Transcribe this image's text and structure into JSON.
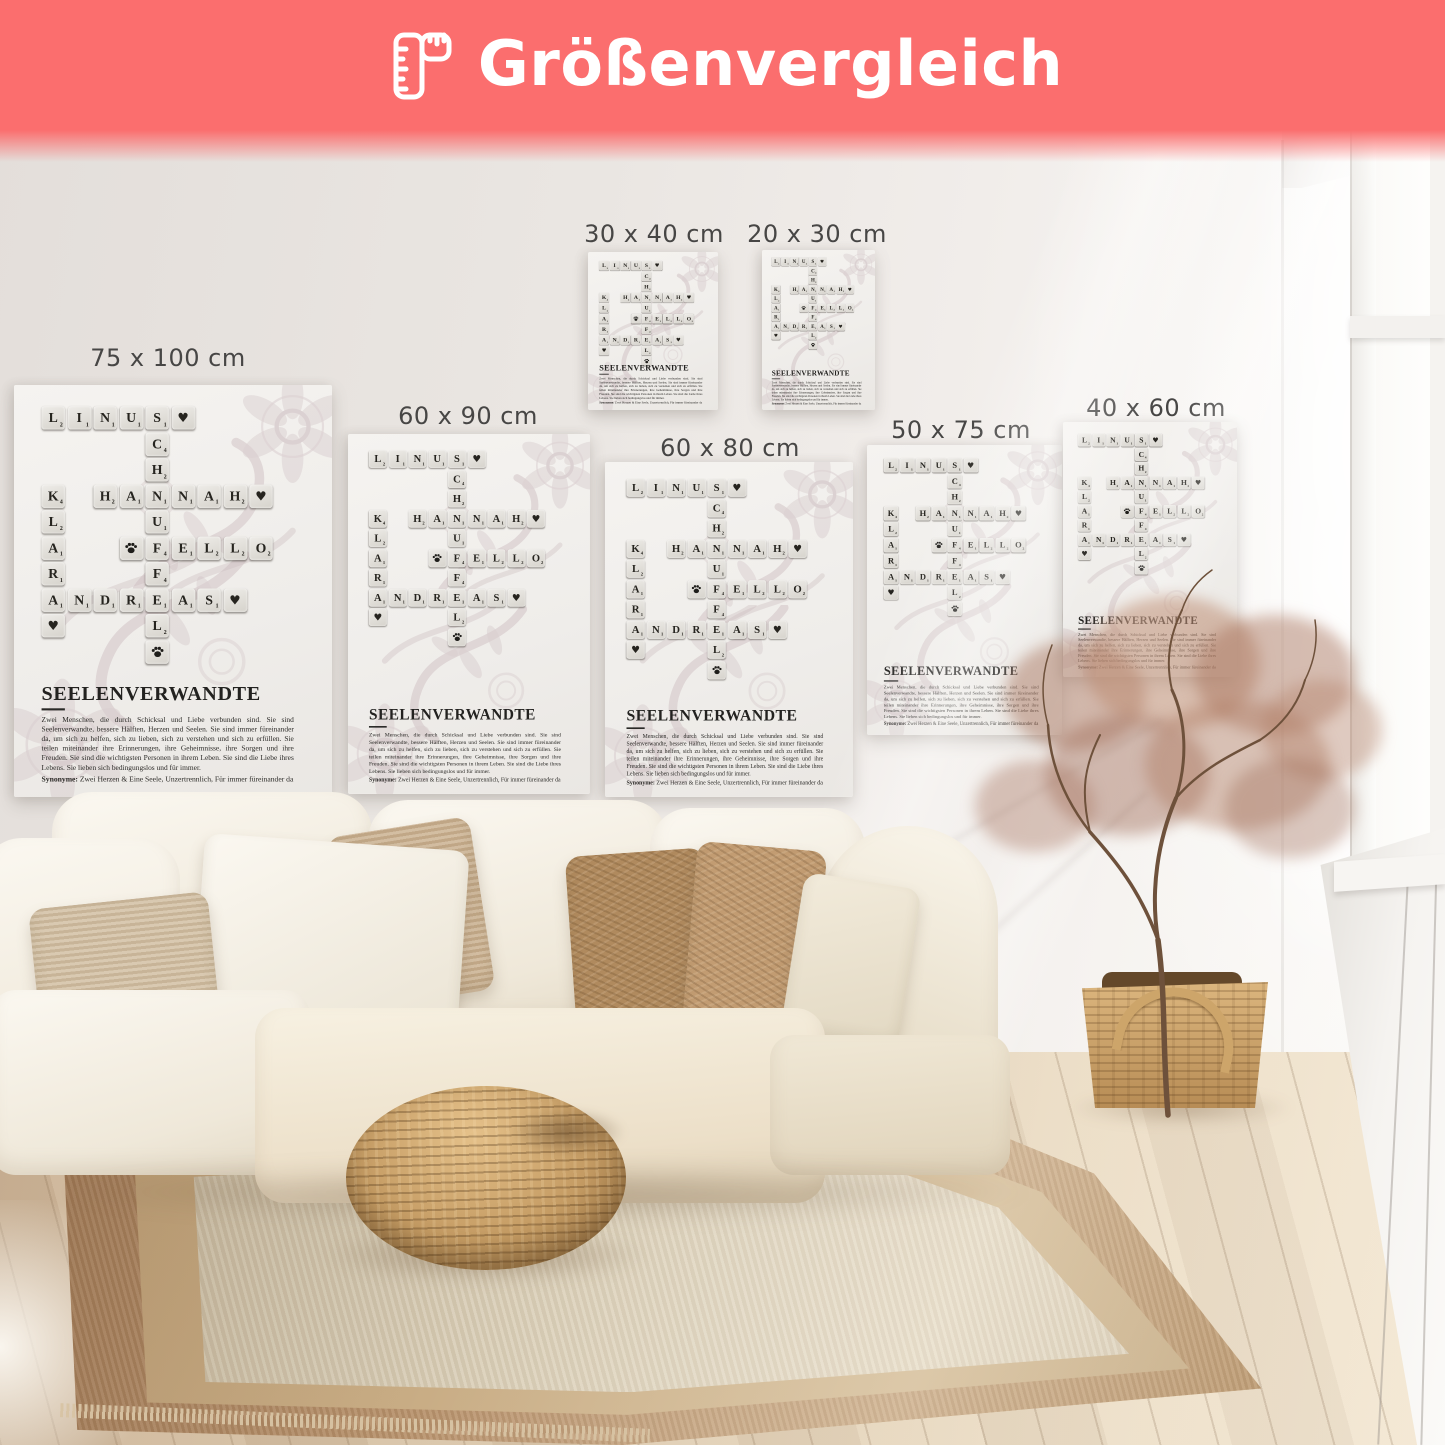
{
  "banner": {
    "title": "Größenvergleich",
    "background": "#fb6e6e",
    "text_color": "#ffffff",
    "icon": "folding-ruler-icon"
  },
  "posters": [
    {
      "size_label": "75 x 100 cm",
      "x": 14,
      "y": 385,
      "w": 318,
      "h": 412,
      "label_cx": 168,
      "label_y": 344
    },
    {
      "size_label": "60 x 90 cm",
      "x": 348,
      "y": 434,
      "w": 242,
      "h": 360,
      "label_cx": 468,
      "label_y": 402
    },
    {
      "size_label": "30 x 40 cm",
      "x": 588,
      "y": 252,
      "w": 130,
      "h": 158,
      "label_cx": 654,
      "label_y": 220
    },
    {
      "size_label": "20 x 30 cm",
      "x": 762,
      "y": 250,
      "w": 113,
      "h": 160,
      "label_cx": 817,
      "label_y": 220
    },
    {
      "size_label": "60 x 80 cm",
      "x": 605,
      "y": 462,
      "w": 248,
      "h": 335,
      "label_cx": 730,
      "label_y": 434
    },
    {
      "size_label": "50 x 75 cm",
      "x": 867,
      "y": 445,
      "w": 195,
      "h": 290,
      "label_cx": 961,
      "label_y": 416
    },
    {
      "size_label": "40 x 60 cm",
      "x": 1063,
      "y": 422,
      "w": 174,
      "h": 255,
      "label_cx": 1156,
      "label_y": 394
    }
  ],
  "poster_design": {
    "words": [
      "LINUS",
      "SCHNUFFEL",
      "HANNAH",
      "KLARA",
      "FELLO",
      "ANDREAS"
    ],
    "title": "SEELENVERWANDTE",
    "description": "Zwei Menschen, die durch Schicksal und Liebe verbunden sind. Sie sind Seelenverwandte, bessere Hälften, Herzen und Seelen. Sie sind immer füreinander da, um sich zu helfen, sich zu lieben, sich zu verstehen und sich zu erfüllen. Sie teilen miteinander ihre Erinnerungen, ihre Geheimnisse, ihre Sorgen und ihre Freuden. Sie sind die wichtigsten Personen in ihrem Leben. Sie sind die Liebe ihres Lebens. Sie lieben sich bedingungslos und für immer.",
    "synonyms_label": "Synonyme:",
    "synonyms": "Zwei Herzen & Eine Seele, Unzertrennlich, Für immer füreinander da",
    "grid": {
      "cols": 9,
      "rows": 10,
      "cells": [
        {
          "t": "L",
          "r": 0,
          "c": 0,
          "v": 2
        },
        {
          "t": "I",
          "r": 0,
          "c": 1,
          "v": 1
        },
        {
          "t": "N",
          "r": 0,
          "c": 2,
          "v": 1
        },
        {
          "t": "U",
          "r": 0,
          "c": 3,
          "v": 1
        },
        {
          "t": "S",
          "r": 0,
          "c": 4,
          "v": 1
        },
        {
          "t": "♥",
          "r": 0,
          "c": 5
        },
        {
          "t": "C",
          "r": 1,
          "c": 4,
          "v": 4
        },
        {
          "t": "H",
          "r": 2,
          "c": 4,
          "v": 2
        },
        {
          "t": "K",
          "r": 3,
          "c": 0,
          "v": 4
        },
        {
          "t": "H",
          "r": 3,
          "c": 2,
          "v": 2
        },
        {
          "t": "A",
          "r": 3,
          "c": 3,
          "v": 1
        },
        {
          "t": "N",
          "r": 3,
          "c": 4,
          "v": 1
        },
        {
          "t": "N",
          "r": 3,
          "c": 5,
          "v": 1
        },
        {
          "t": "A",
          "r": 3,
          "c": 6,
          "v": 1
        },
        {
          "t": "H",
          "r": 3,
          "c": 7,
          "v": 2
        },
        {
          "t": "♥",
          "r": 3,
          "c": 8
        },
        {
          "t": "L",
          "r": 4,
          "c": 0,
          "v": 2
        },
        {
          "t": "U",
          "r": 4,
          "c": 4,
          "v": 1
        },
        {
          "t": "A",
          "r": 5,
          "c": 0,
          "v": 1
        },
        {
          "t": "paw",
          "r": 5,
          "c": 3
        },
        {
          "t": "F",
          "r": 5,
          "c": 4,
          "v": 4
        },
        {
          "t": "E",
          "r": 5,
          "c": 5,
          "v": 1
        },
        {
          "t": "L",
          "r": 5,
          "c": 6,
          "v": 2
        },
        {
          "t": "L",
          "r": 5,
          "c": 7,
          "v": 2
        },
        {
          "t": "O",
          "r": 5,
          "c": 8,
          "v": 2
        },
        {
          "t": "R",
          "r": 6,
          "c": 0,
          "v": 1
        },
        {
          "t": "F",
          "r": 6,
          "c": 4,
          "v": 4
        },
        {
          "t": "A",
          "r": 7,
          "c": 0,
          "v": 1
        },
        {
          "t": "N",
          "r": 7,
          "c": 1,
          "v": 1
        },
        {
          "t": "D",
          "r": 7,
          "c": 2,
          "v": 1
        },
        {
          "t": "R",
          "r": 7,
          "c": 3,
          "v": 1
        },
        {
          "t": "E",
          "r": 7,
          "c": 4,
          "v": 1
        },
        {
          "t": "A",
          "r": 7,
          "c": 5,
          "v": 1
        },
        {
          "t": "S",
          "r": 7,
          "c": 6,
          "v": 1
        },
        {
          "t": "♥",
          "r": 7,
          "c": 7
        },
        {
          "t": "♥",
          "r": 8,
          "c": 0
        },
        {
          "t": "L",
          "r": 8,
          "c": 4,
          "v": 2
        },
        {
          "t": "paw",
          "r": 9,
          "c": 4
        }
      ]
    },
    "colors": {
      "paper": "#f2f0ed",
      "tile": "#dcd9d3",
      "tile_text": "#26241f",
      "ornament": "#c9b8bc"
    }
  },
  "scene": {
    "colors": {
      "wall": "#eae6e2",
      "floor": "#dcc9af",
      "rug_border": "#b5916c",
      "rug_field": "#ddd2bc",
      "sofa": "#f5f0e6",
      "pouf": "#c09a63",
      "plant_foliage": "#ad7f6d",
      "basket": "#c89f66",
      "window_light": "#fdfdfc"
    }
  }
}
